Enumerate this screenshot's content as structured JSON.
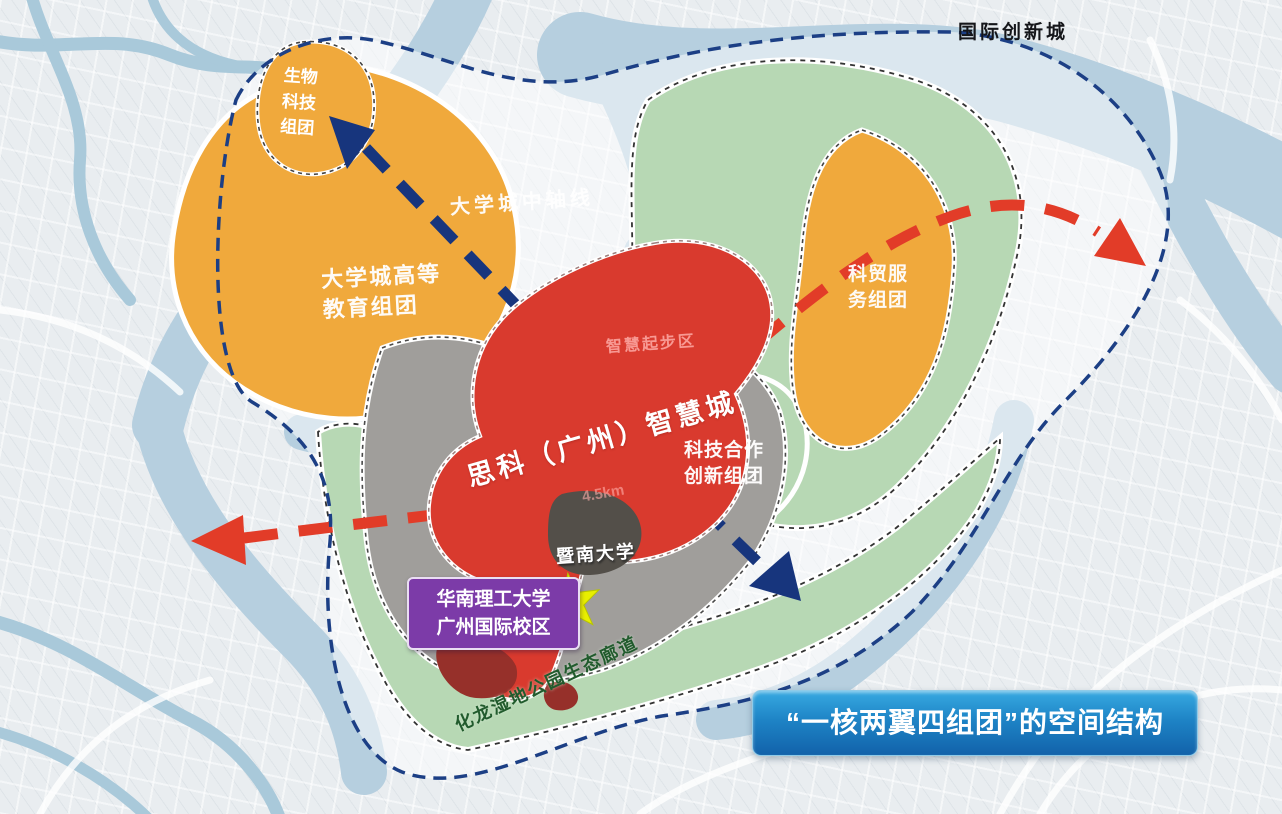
{
  "labels": {
    "region": "国际创新城",
    "axis": "大学城中轴线",
    "core": "思科（广州）智慧城",
    "startup_zone": "智慧起步区",
    "area_note": "4.5km",
    "jinan_university": "暨南大学",
    "scut_line1": "华南理工大学",
    "scut_line2": "广州国际校区",
    "corridor": "化龙湿地公园生态廊道",
    "banner": "“一核两翼四组团”的空间结构"
  },
  "clusters": {
    "biotech": {
      "line1": "生物",
      "line2": "科技",
      "line3": "组团"
    },
    "higher_ed": {
      "line1": "大学城高等",
      "line2": "教育组团"
    },
    "trade_service": {
      "line1": "科贸服",
      "line2": "务组团"
    },
    "scitech_coop": {
      "line1": "科技合作",
      "line2": "创新组团"
    }
  },
  "colors": {
    "orange_cluster": "#f0a93c",
    "green_ecology": "#b7d8b4",
    "red_core": "#d93a2e",
    "dark_red_patch": "#96302a",
    "gray_builtup": "#a09e9b",
    "dark_campus": "#534f49",
    "river": "#b6cfdf",
    "stream": "#a9c9da",
    "boundary_navy": "#1c3f85",
    "axis_blue": "#17357d",
    "axis_red": "#e23c28",
    "purple_box": "#7c3ba8",
    "banner_blue": "#1a79c0",
    "star_yellow": "#e8ef00",
    "corridor_text_green": "#215b2d",
    "halo_white": "rgba(255,255,255,0.5)"
  }
}
